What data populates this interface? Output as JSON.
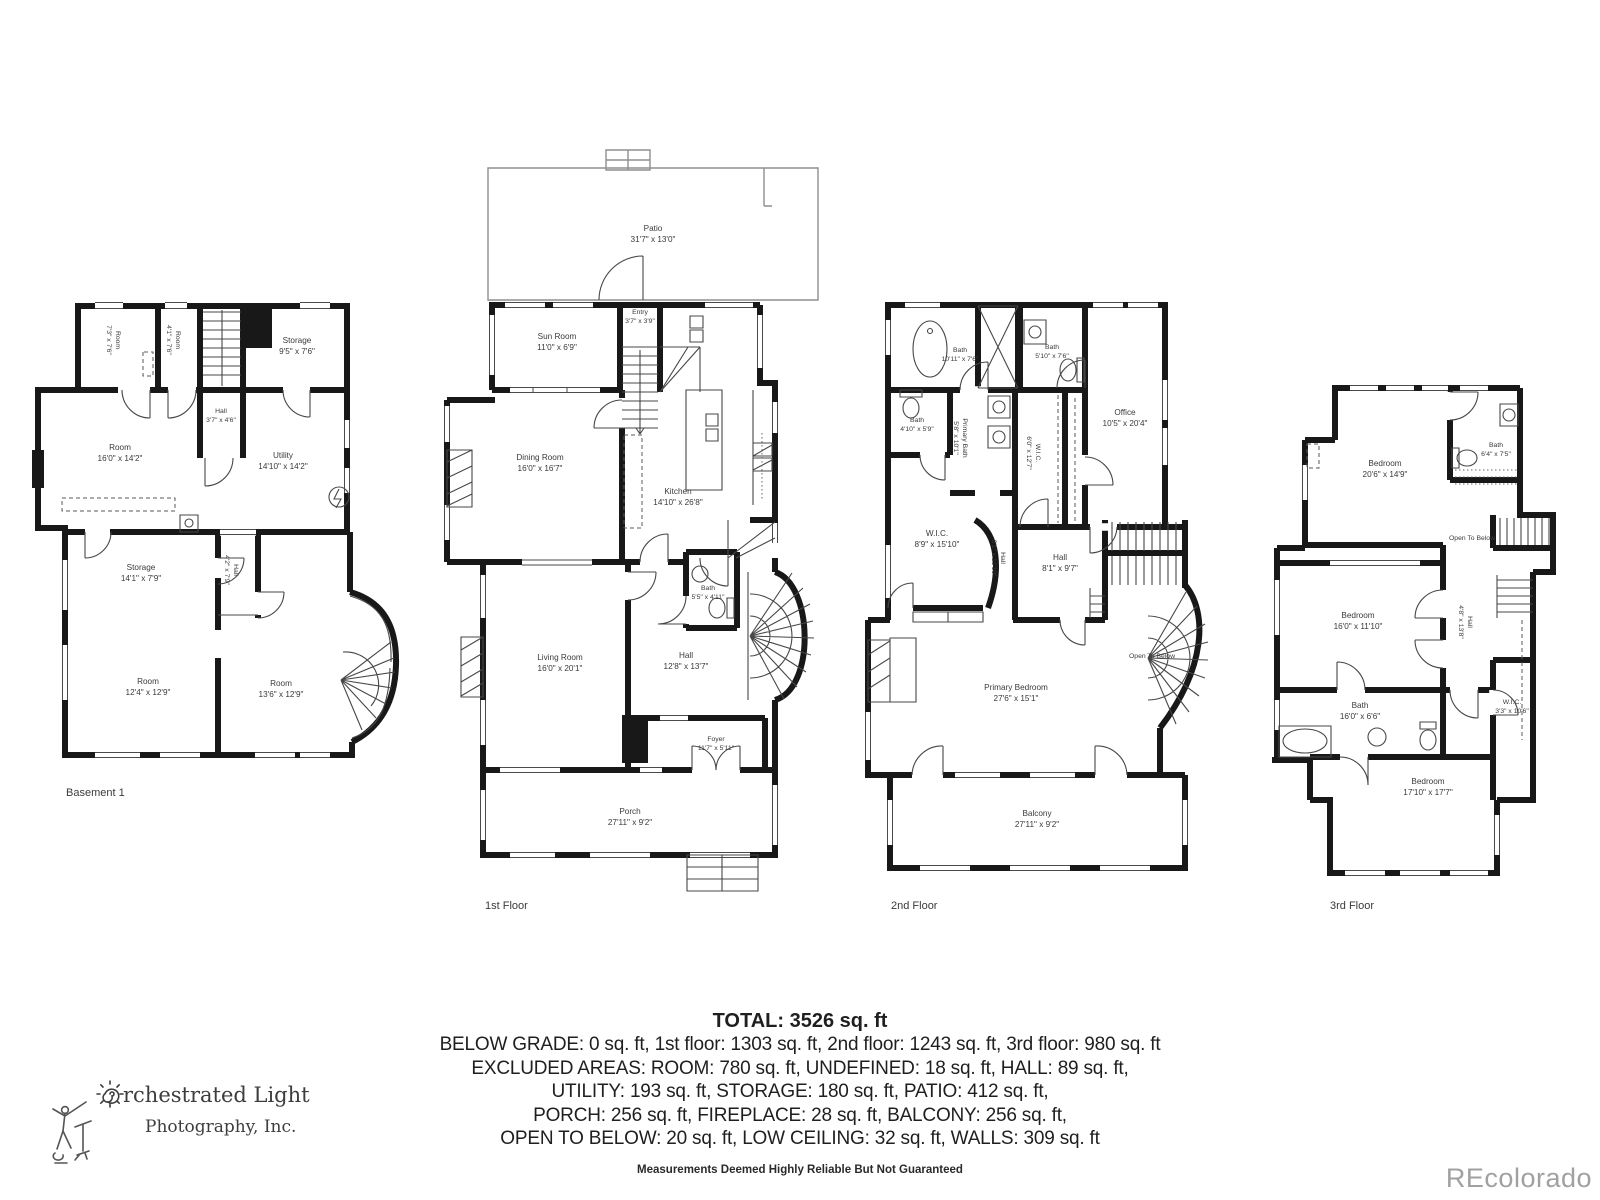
{
  "watermark": "REcolorado",
  "logo": {
    "icon": "sun-spiral-icon",
    "figure": "conductor-figure-icon",
    "line1": "rchestrated Light",
    "line2": "Photography, Inc."
  },
  "summary": {
    "total": "TOTAL: 3526 sq. ft",
    "lines": [
      "BELOW GRADE: 0 sq. ft, 1st floor: 1303 sq. ft, 2nd floor: 1243 sq. ft, 3rd floor: 980 sq. ft",
      "EXCLUDED AREAS: ROOM: 780 sq. ft, UNDEFINED: 18 sq. ft, HALL: 89 sq. ft,",
      "UTILITY: 193 sq. ft, STORAGE: 180 sq. ft, PATIO: 412 sq. ft,",
      "PORCH: 256 sq. ft, FIREPLACE: 28 sq. ft, BALCONY: 256 sq. ft,",
      "OPEN TO BELOW: 20 sq. ft, LOW CEILING: 32 sq. ft, WALLS: 309 sq. ft"
    ],
    "disclaimer": "Measurements Deemed Highly Reliable But Not Guaranteed"
  },
  "icons": {
    "electrical_panel": "electrical-panel-icon"
  },
  "floors": [
    {
      "label": "Basement 1",
      "rooms": [
        {
          "name": "Room",
          "dims": "7'3\" x 7'6\""
        },
        {
          "name": "Room",
          "dims": "4'1\" x 7'6\""
        },
        {
          "name": "Storage",
          "dims": "9'5\" x 7'6\""
        },
        {
          "name": "Hall",
          "dims": "3'7\" x 4'6\""
        },
        {
          "name": "Room",
          "dims": "16'0\" x 14'2\""
        },
        {
          "name": "Utility",
          "dims": "14'10\" x 14'2\""
        },
        {
          "name": "Storage",
          "dims": "14'1\" x 7'9\""
        },
        {
          "name": "Hall",
          "dims": "4'2\" x 7'9\""
        },
        {
          "name": "Room",
          "dims": "12'4\" x 12'9\""
        },
        {
          "name": "Room",
          "dims": "13'6\" x 12'9\""
        }
      ]
    },
    {
      "label": "1st Floor",
      "rooms": [
        {
          "name": "Patio",
          "dims": "31'7\" x 13'0\""
        },
        {
          "name": "Sun Room",
          "dims": "11'0\" x 6'9\""
        },
        {
          "name": "Entry",
          "dims": "3'7\" x 3'9\""
        },
        {
          "name": "Dining Room",
          "dims": "16'0\" x 16'7\""
        },
        {
          "name": "Kitchen",
          "dims": "14'10\" x 26'8\""
        },
        {
          "name": "Bath",
          "dims": "5'5\" x 4'11\""
        },
        {
          "name": "Living Room",
          "dims": "16'0\" x 20'1\""
        },
        {
          "name": "Hall",
          "dims": "12'8\" x 13'7\""
        },
        {
          "name": "Foyer",
          "dims": "11'7\" x 5'11\""
        },
        {
          "name": "Porch",
          "dims": "27'11\" x 9'2\""
        }
      ]
    },
    {
      "label": "2nd Floor",
      "rooms": [
        {
          "name": "Bath",
          "dims": "10'11\" x 7'6\""
        },
        {
          "name": "Bath",
          "dims": "5'10\" x 7'6\""
        },
        {
          "name": "Bath",
          "dims": "4'10\" x 5'9\""
        },
        {
          "name": "Primary Bath",
          "dims": "5'8\" x 10'1\""
        },
        {
          "name": "W.I.C.",
          "dims": "6'0\" x 12'7\""
        },
        {
          "name": "Office",
          "dims": "10'5\" x 20'4\""
        },
        {
          "name": "W.I.C.",
          "dims": "8'9\" x 15'10\""
        },
        {
          "name": "Hall",
          "dims": "3'1\" x 11'10\""
        },
        {
          "name": "Hall",
          "dims": "8'1\" x 9'7\""
        },
        {
          "name": "Open To Below",
          "dims": ""
        },
        {
          "name": "Primary Bedroom",
          "dims": "27'6\" x 15'1\""
        },
        {
          "name": "Balcony",
          "dims": "27'11\" x 9'2\""
        }
      ]
    },
    {
      "label": "3rd Floor",
      "rooms": [
        {
          "name": "Bedroom",
          "dims": "20'6\" x 14'9\""
        },
        {
          "name": "Bath",
          "dims": "6'4\" x 7'5\""
        },
        {
          "name": "Open To Below",
          "dims": ""
        },
        {
          "name": "Bedroom",
          "dims": "16'0\" x 11'10\""
        },
        {
          "name": "Hall",
          "dims": "4'8\" x 13'8\""
        },
        {
          "name": "W.I.C.",
          "dims": "3'3\" x 10'6\""
        },
        {
          "name": "Bath",
          "dims": "16'0\" x 6'6\""
        },
        {
          "name": "Bedroom",
          "dims": "17'10\" x 17'7\""
        }
      ]
    }
  ]
}
